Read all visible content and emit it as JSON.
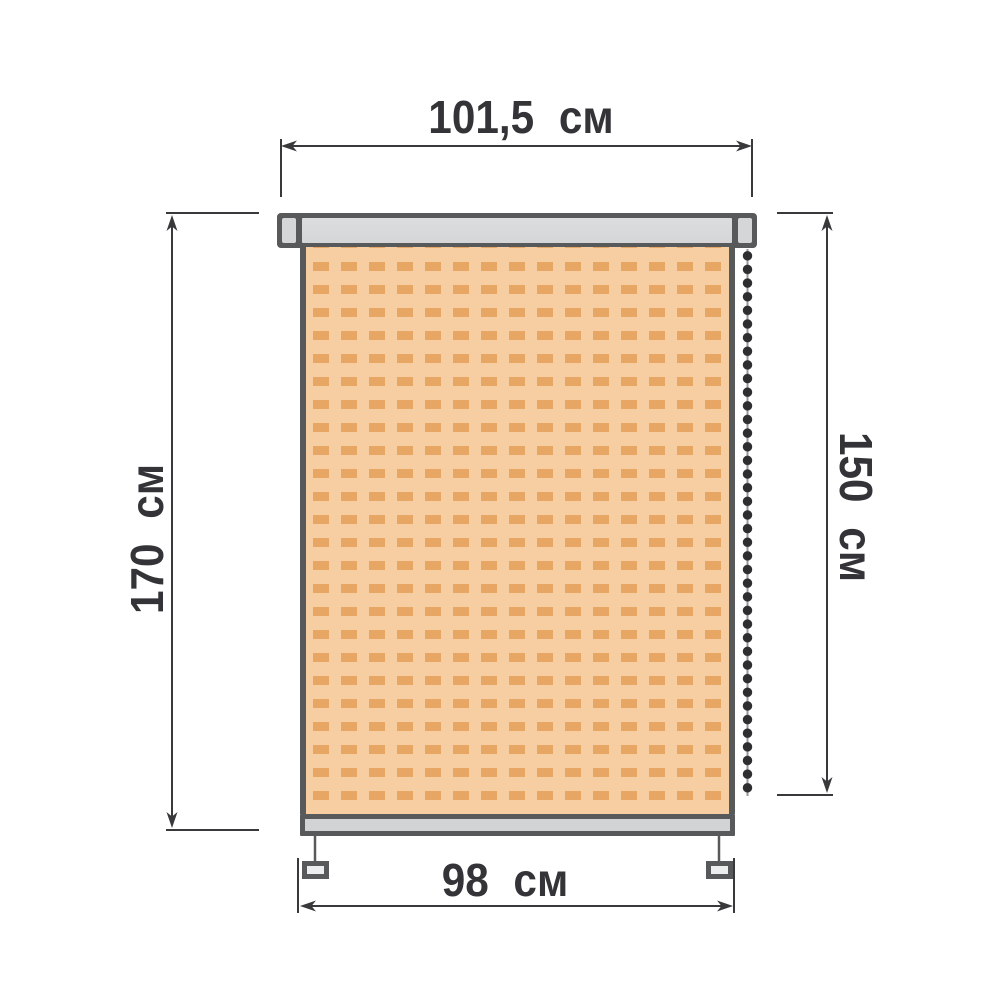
{
  "dimensions": {
    "cassette_width": "101,5 см",
    "total_height": "170 см",
    "fabric_height": "150 см",
    "fabric_width": "98 см"
  },
  "colors": {
    "background": "#ffffff",
    "outline": "#58595b",
    "dim_line": "#39393b",
    "text": "#343438",
    "cassette_fill": "#d5d6d8",
    "rail_fill": "#d2d3d5",
    "bracket_fill": "#eceded",
    "fabric_bg": "#f7cea2",
    "fabric_dash": "#e8a665",
    "chain_bead": "#2e2e30",
    "chain_cord": "#96979a"
  }
}
